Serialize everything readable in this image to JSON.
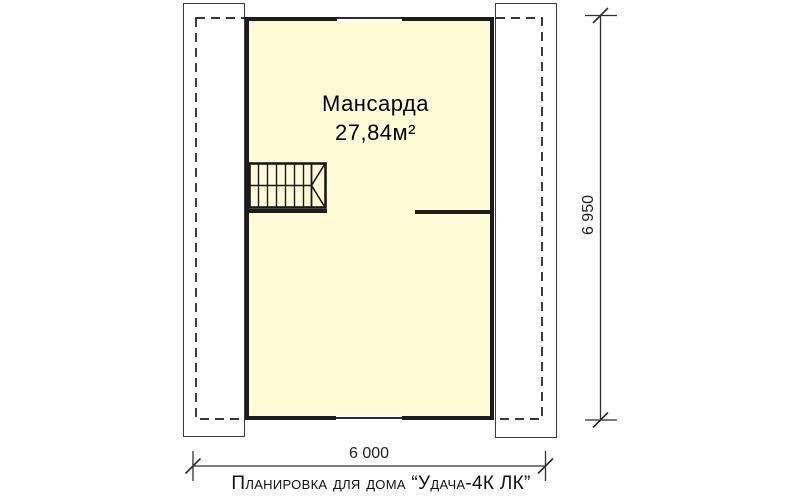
{
  "floor_plan": {
    "room": {
      "name": "Мансарда",
      "area": "27,84м²"
    },
    "dimensions": {
      "horizontal": "6 000",
      "vertical": "6 950"
    },
    "caption": "Планировка для дома “Удача-4К ЛК”",
    "colors": {
      "room_fill": "#FFFBD6",
      "wall": "#1C1C1C",
      "dashed_roof_line": "#1A1A1A",
      "dimension_line": "#2F2F2F"
    }
  }
}
